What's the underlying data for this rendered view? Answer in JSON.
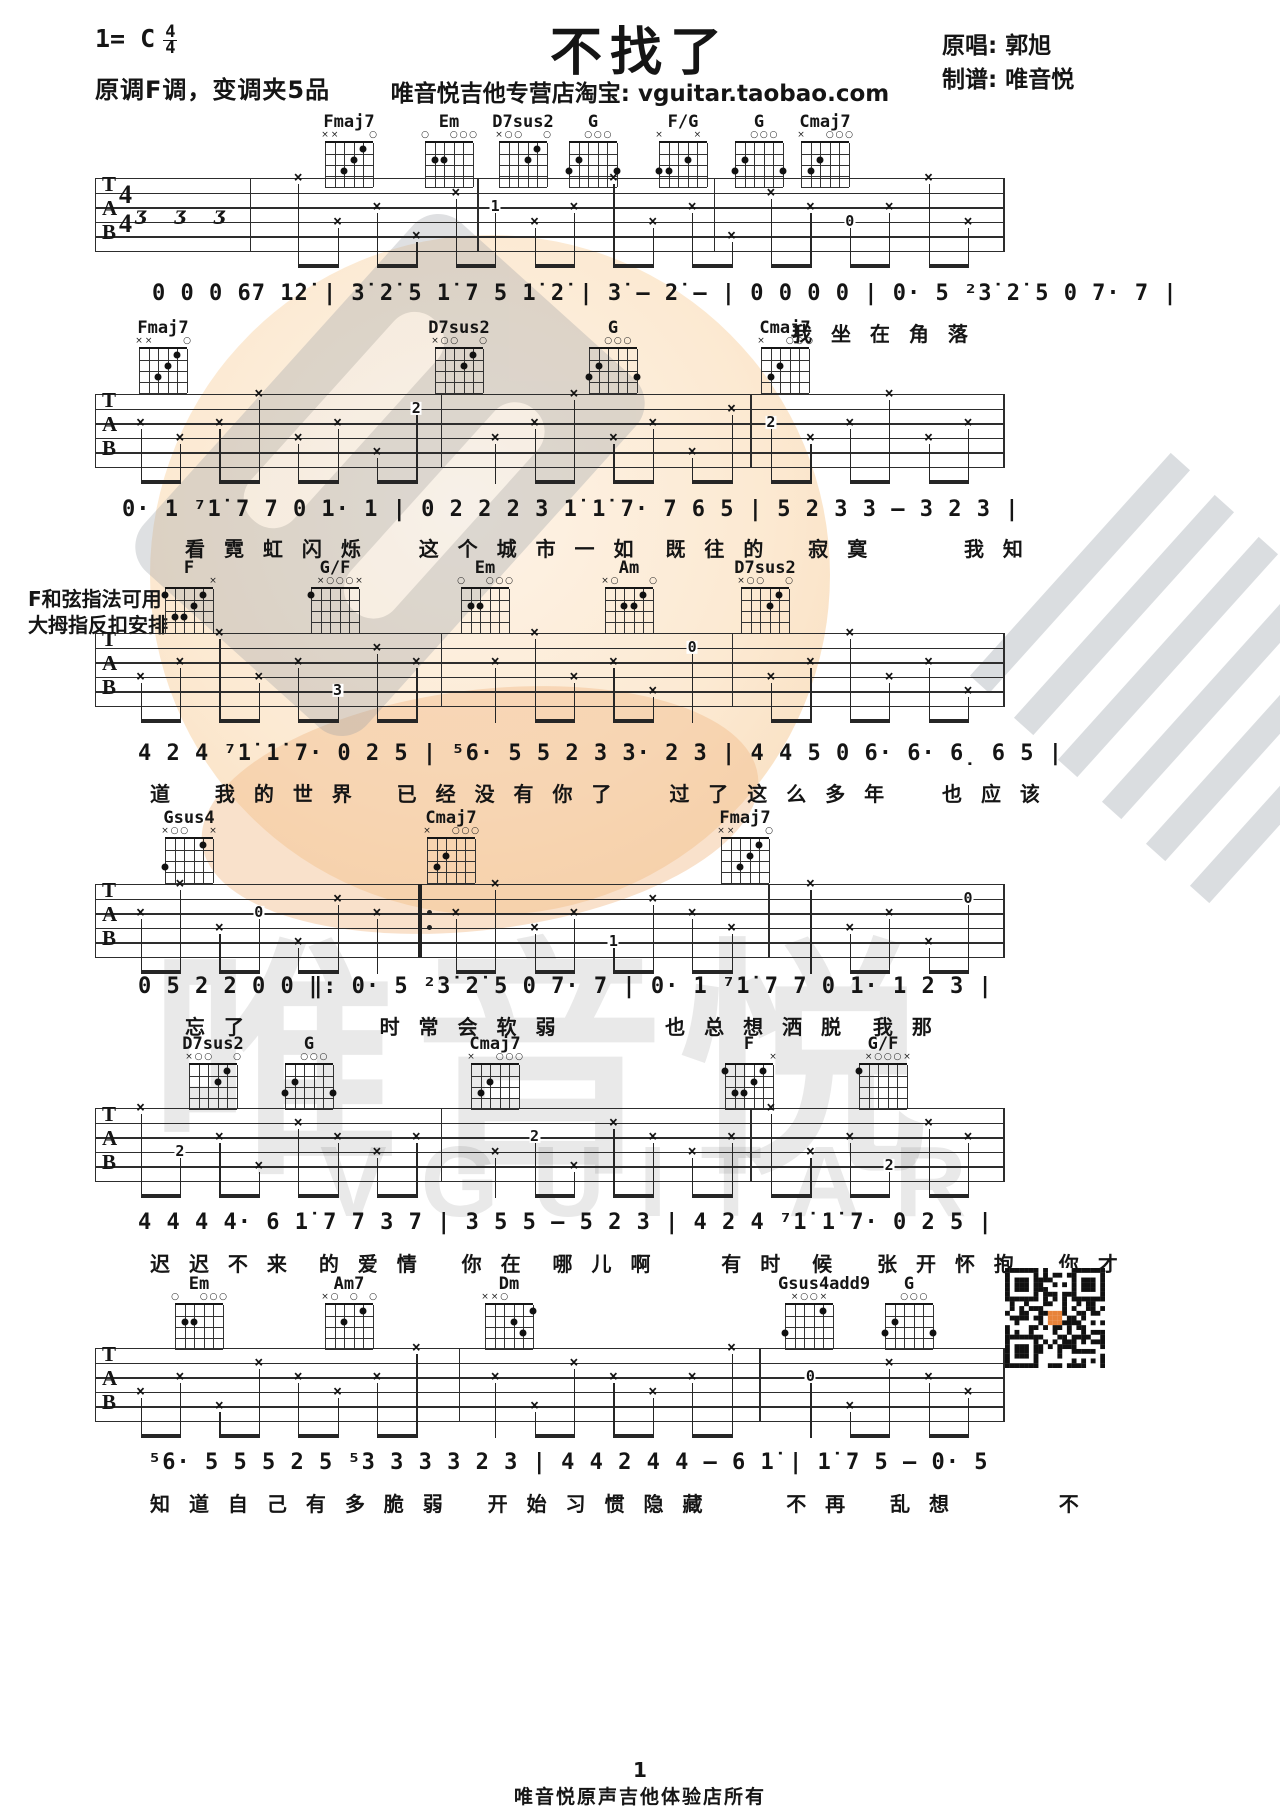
{
  "header": {
    "key": "1= C",
    "time_top": "4",
    "time_bottom": "4",
    "capo_note": "原调F调，变调夹5品",
    "title": "不找了",
    "store_line": "唯音悦吉他专营店淘宝: vguitar.taobao.com",
    "singer": "原唱: 郭旭",
    "tab_maker": "制谱: 唯音悦"
  },
  "side_note": {
    "line1": "F和弦指法可用",
    "line2": "大拇指反扣安排"
  },
  "staff": {
    "labels": [
      "T",
      "A",
      "B"
    ],
    "time_top": "4",
    "time_bottom": "4"
  },
  "chord_defs": {
    "Fmaj7": {
      "top": [
        "x",
        "x",
        "",
        "",
        "",
        "o"
      ],
      "dots": [
        [
          4,
          3
        ],
        [
          3,
          2
        ],
        [
          2,
          1
        ]
      ]
    },
    "Em": {
      "top": [
        "o",
        "",
        "",
        "o",
        "o",
        "o"
      ],
      "dots": [
        [
          5,
          2
        ],
        [
          4,
          2
        ]
      ]
    },
    "D7sus2": {
      "top": [
        "x",
        "o",
        "o",
        "",
        "",
        "o"
      ],
      "dots": [
        [
          3,
          2
        ],
        [
          2,
          1
        ]
      ]
    },
    "G": {
      "top": [
        "",
        "",
        "o",
        "o",
        "o",
        ""
      ],
      "dots": [
        [
          6,
          3
        ],
        [
          5,
          2
        ],
        [
          1,
          3
        ]
      ]
    },
    "F/G": {
      "top": [
        "x",
        "",
        "",
        "",
        "x",
        ""
      ],
      "dots": [
        [
          6,
          3
        ],
        [
          5,
          3
        ],
        [
          3,
          2
        ]
      ]
    },
    "Cmaj7": {
      "top": [
        "x",
        "",
        "",
        "o",
        "o",
        "o"
      ],
      "dots": [
        [
          5,
          3
        ],
        [
          4,
          2
        ]
      ]
    },
    "F": {
      "top": [
        "",
        "",
        "",
        "",
        "",
        "x"
      ],
      "dots": [
        [
          6,
          1
        ],
        [
          5,
          3
        ],
        [
          4,
          3
        ],
        [
          3,
          2
        ],
        [
          2,
          1
        ]
      ]
    },
    "G/F": {
      "top": [
        "",
        "x",
        "o",
        "o",
        "o",
        "x"
      ],
      "dots": [
        [
          6,
          1
        ]
      ]
    },
    "Am": {
      "top": [
        "x",
        "o",
        "",
        "",
        "",
        "o"
      ],
      "dots": [
        [
          4,
          2
        ],
        [
          3,
          2
        ],
        [
          2,
          1
        ]
      ]
    },
    "Gsus4": {
      "top": [
        "x",
        "o",
        "o",
        "",
        "",
        "x"
      ],
      "dots": [
        [
          6,
          3
        ],
        [
          2,
          1
        ]
      ]
    },
    "Am7": {
      "top": [
        "x",
        "o",
        "",
        "o",
        "",
        "o"
      ],
      "dots": [
        [
          4,
          2
        ],
        [
          2,
          1
        ]
      ]
    },
    "Dm": {
      "top": [
        "x",
        "x",
        "o",
        "",
        "",
        ""
      ],
      "dots": [
        [
          3,
          2
        ],
        [
          2,
          3
        ],
        [
          1,
          1
        ]
      ]
    },
    "Gsus4add9": {
      "top": [
        "",
        "x",
        "o",
        "o",
        "x",
        ""
      ],
      "dots": [
        [
          6,
          3
        ],
        [
          2,
          1
        ]
      ]
    }
  },
  "systems": [
    {
      "chords": [
        {
          "name": "Fmaj7",
          "x": 318
        },
        {
          "name": "Em",
          "x": 418
        },
        {
          "name": "D7sus2",
          "x": 492
        },
        {
          "name": "G",
          "x": 562
        },
        {
          "name": "F/G",
          "x": 652
        },
        {
          "name": "G",
          "x": 728
        },
        {
          "name": "Cmaj7",
          "x": 794
        }
      ],
      "melody": "0 0 0 67 1̇2̇ | 3̇ 2̇ 5 1̇ 7 5 1̇ 2̇ | 3̇ – 2̇ – | 0 0 0 0 | 0· 5 ²3̇ 2̇ 5 0 7· 7 |",
      "lyrics": "我 坐 在 角 落"
    },
    {
      "chords": [
        {
          "name": "Fmaj7",
          "x": 132
        },
        {
          "name": "D7sus2",
          "x": 428
        },
        {
          "name": "G",
          "x": 582
        },
        {
          "name": "Cmaj7",
          "x": 754
        }
      ],
      "melody": "0· 1 ⁷1̇ 7 7 0 1· 1 | 0 2 2 2 3 1̇ 1̇ 7· 7 6 5 | 5 2 3 3 – 3 2 3 |",
      "lyrics": "看 霓 虹 闪 烁    这 个 城 市 一 如  既 往 的   寂 寞       我 知"
    },
    {
      "chords": [
        {
          "name": "F",
          "x": 158
        },
        {
          "name": "G/F",
          "x": 304
        },
        {
          "name": "Em",
          "x": 454
        },
        {
          "name": "Am",
          "x": 598
        },
        {
          "name": "D7sus2",
          "x": 734
        }
      ],
      "melody": "4 2 4 ⁷1̇ 1̇ 7· 0 2 5 | ⁵6· 5 5 2 3 3· 2 3 | 4 4 5 0 6· 6· 6̣ 6 5 |",
      "lyrics": "道   我 的 世 界   已 经 没 有 你 了    过 了 这 么 多 年    也 应 该"
    },
    {
      "chords": [
        {
          "name": "Gsus4",
          "x": 158
        },
        {
          "name": "Cmaj7",
          "x": 420
        },
        {
          "name": "Fmaj7",
          "x": 714
        }
      ],
      "melody": "0 5 2 2 0 0 ‖: 0· 5 ²3̇ 2̇ 5 0 7· 7 | 0· 1 ⁷1̇ 7 7 0 1· 1 2 3 |",
      "lyrics": "忘 了          时 常 会 软 弱        也 总 想 洒 脱  我 那"
    },
    {
      "chords": [
        {
          "name": "D7sus2",
          "x": 182
        },
        {
          "name": "G",
          "x": 278
        },
        {
          "name": "Cmaj7",
          "x": 464
        },
        {
          "name": "F",
          "x": 718
        },
        {
          "name": "G/F",
          "x": 852
        }
      ],
      "melody": "4 4 4 4· 6 1̇ 7 7 3 7 | 3 5 5 – 5 2 3 | 4 2 4 ⁷1̇ 1̇ 7· 0 2 5 |",
      "lyrics": "迟 迟 不 来  的 爱 情   你 在  哪 儿 啊     有 时  候   张 开 怀 抱   你 才"
    },
    {
      "chords": [
        {
          "name": "Em",
          "x": 168
        },
        {
          "name": "Am7",
          "x": 318
        },
        {
          "name": "Dm",
          "x": 478
        },
        {
          "name": "Gsus4add9",
          "x": 778
        },
        {
          "name": "G",
          "x": 878
        }
      ],
      "melody": "⁵6· 5 5 5 2 5 ⁵3 3 3 3 2 3 | 4 4 2 4 4 – 6 1̇ | 1̇ 7 5 – 0· 5",
      "lyrics": "知 道 自 己 有 多 脆 弱   开 始 习 惯 隐 藏      不 再   乱 想        不"
    }
  ],
  "footer": {
    "page": "1",
    "owner": "唯音悦原声吉他体验店所有"
  },
  "watermark": {
    "brand_cn": "唯音悦",
    "brand_en": "VGUITAR"
  }
}
